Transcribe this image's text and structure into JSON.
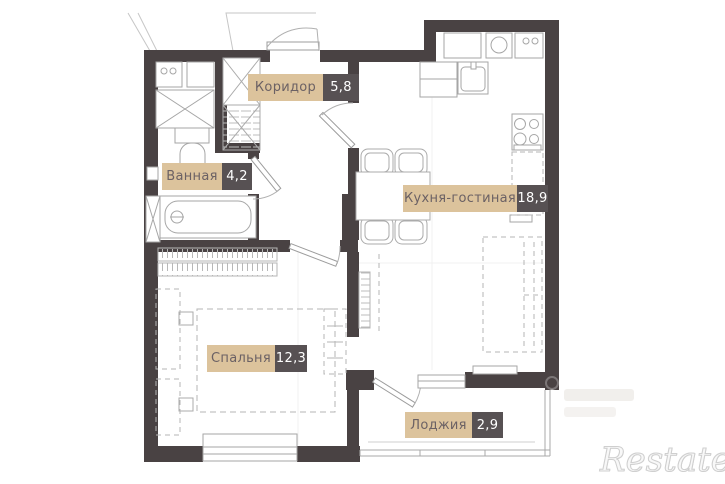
{
  "rooms": [
    {
      "id": "corridor",
      "label": "Коридор",
      "area": "5,8"
    },
    {
      "id": "bathroom",
      "label": "Ванная",
      "area": "4,2"
    },
    {
      "id": "kitchen-living",
      "label": "Кухня-гостиная",
      "area": "18,9"
    },
    {
      "id": "bedroom",
      "label": "Спальня",
      "area": "12,3"
    },
    {
      "id": "loggia",
      "label": "Лоджия",
      "area": "2,9"
    }
  ],
  "watermark": {
    "brand": "Restate"
  },
  "colors": {
    "wall": "#494243",
    "label_bg": "#dcc39c",
    "label_text": "#6b6164",
    "area_bg": "#575153",
    "area_text": "#ffffff",
    "fixture_line": "#a6a6a6",
    "furniture_dash": "#b5b5b5"
  }
}
